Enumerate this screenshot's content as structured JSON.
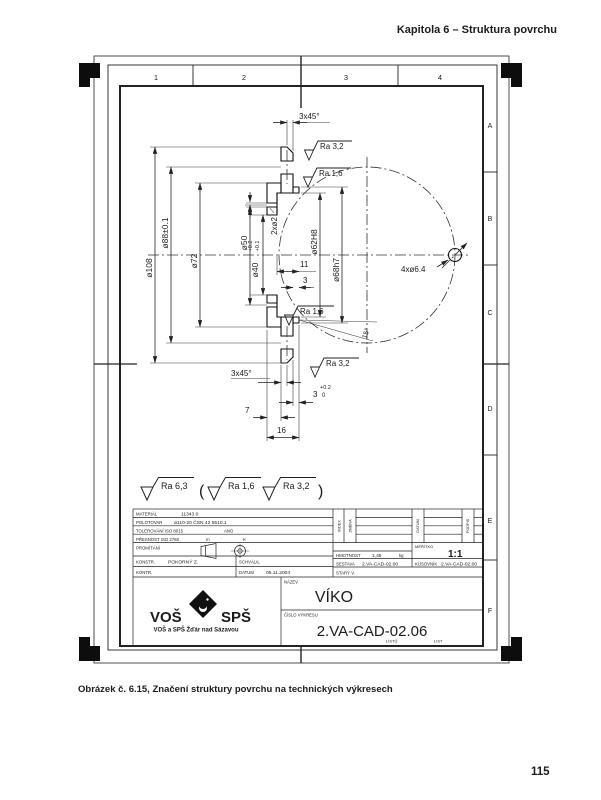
{
  "page": {
    "header": "Kapitola 6 – Struktura povrchu",
    "caption": "Obrázek č. 6.15, Značení struktury povrchu na technických výkresech",
    "page_number": "115"
  },
  "sheet": {
    "zones_top": [
      "1",
      "2",
      "3",
      "4"
    ],
    "zones_right": [
      "A",
      "B",
      "C",
      "D",
      "E",
      "F"
    ]
  },
  "drawing": {
    "labels": {
      "chamfer_top": "3x45°",
      "ra32_top": "Ra  3,2",
      "ra16_top": "Ra  1,6",
      "d108": "ø108",
      "d88": "ø88±0.1",
      "d72": "ø72",
      "d50": "ø50",
      "d2": "2xø2",
      "d40": "ø40",
      "d40_hi": "+0.2",
      "d40_lo": "+0.1",
      "d62": "ø62H8",
      "d68": "ø68h7",
      "len11": "11",
      "len3": "3",
      "ra16_bot": "Ra  1,6",
      "ra32_bot": "Ra  3,2",
      "chamfer_bot": "3x45°",
      "tol3_hi": "+0.2",
      "tol3_val": "3",
      "tol3_lo": "0",
      "len7": "7",
      "len16": "16",
      "holes": "4xø6.4",
      "angle15": "15°"
    },
    "surface_note": {
      "main": "Ra  6,3",
      "paren_open": "(",
      "alt1": "Ra  1,6",
      "alt2": "Ra  3,2",
      "paren_close": ")"
    }
  },
  "titleblock": {
    "material_label": "MATERIÁL",
    "material_value": "11343.0",
    "polotovar_label": "POLOTOVAR",
    "polotovar_value": "ø110-20  ČSN 42 5510.1",
    "tolerovani_label": "TOLEROVÁNÍ  ISO 8015",
    "tolerovani_value": "ANO",
    "presnost_label": "PŘESNOST  ISO 2768",
    "presnost_m": "m",
    "presnost_k": "K",
    "promitani_label": "PROMÍTÁNÍ",
    "index_label": "INDEX",
    "zmena_label": "ZMĚNA",
    "datum_col_label": "DATUM",
    "podpis_label": "PODPIS",
    "konstr_label": "KONSTR.",
    "konstr_value": "POKORNÝ Z.",
    "schvalil_label": "SCHVÁLIL",
    "kontr_label": "KONTR.",
    "datum_label": "DATUM",
    "datum_value": "05.11.2004",
    "hmotnost_label": "HMOTNOST",
    "hmotnost_value": "1,49",
    "hmotnost_unit": "kg",
    "meritko_label": "MĚŘÍTKO",
    "meritko_value": "1:1",
    "sestava_label": "SESTAVA",
    "sestava_value": "2.VA-CAD-02.00",
    "kusovnik_label": "KUSOVNÍK",
    "kusovnik_value": "2.VA-CAD-02.00",
    "stary_label": "STARÝ V.",
    "nazev_label": "NÁZEV",
    "nazev_value": "VÍKO",
    "cislo_label": "ČÍSLO VÝKRESU",
    "cislo_value": "2.VA-CAD-02.06",
    "listu_label": "LISTŮ",
    "list_label": "LIST",
    "logo": {
      "vos": "VOŠ",
      "sps": "SPŠ",
      "tagline": "VOŠ a SPŠ Žďár nad Sázavou"
    }
  },
  "colors": {
    "accent": "#701d14",
    "line": "#222222"
  }
}
